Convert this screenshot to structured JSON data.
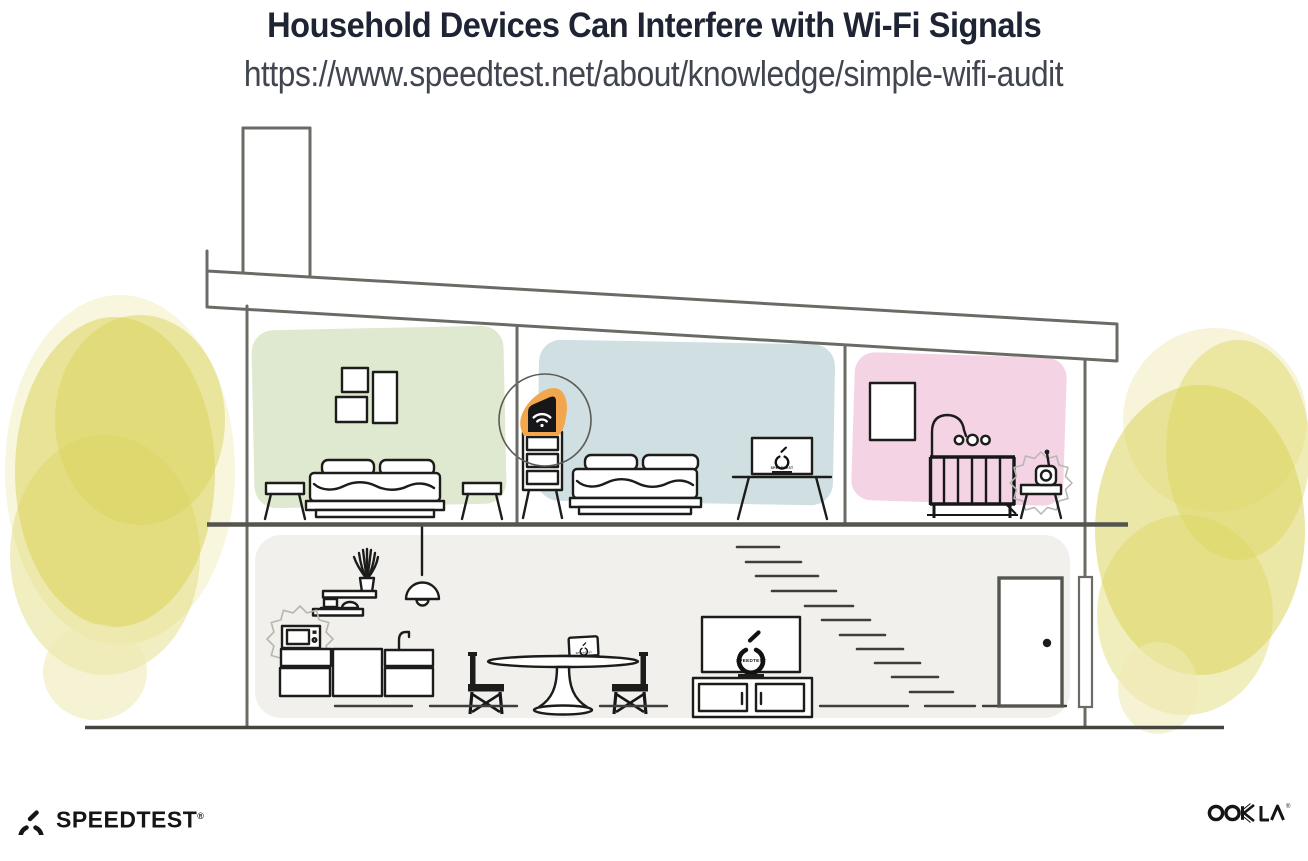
{
  "header": {
    "title": "Household Devices Can Interfere with Wi-Fi Signals",
    "url": "https://www.speedtest.net/about/knowledge/simple-wifi-audit"
  },
  "illustration": {
    "screens": {
      "bedroom_tv_label": "SPEEDTEST",
      "living_tv_label": "SPEEDTEST",
      "laptop_label": "SPEEDTEST"
    },
    "icons": {
      "router": "wifi-icon",
      "tv_logo": "speedtest-gauge-icon",
      "interference": "spiky-blob"
    }
  },
  "footer": {
    "speedtest_wordmark": "SPEEDTEST",
    "speedtest_registered": "®",
    "ookla_wordmark": "OOKLA",
    "ookla_registered": "®"
  },
  "colors": {
    "title": "#1e2433",
    "url-text": "#40454f",
    "wall-stroke": "#6b6b66",
    "dark-stroke": "#1c1c1a",
    "floor-stroke": "#45453f",
    "room-green": "#dfe9cf",
    "room-blue": "#cfdfe2",
    "room-pink": "#f3d3e4",
    "floor-gray": "#f1f0ed",
    "tree-yellow": "#dbd45c",
    "tree-yellow-light": "#efeab3",
    "accent-orange": "#f2a64d",
    "blob-stroke": "#b7b7b0",
    "logo-ink": "#151517"
  }
}
